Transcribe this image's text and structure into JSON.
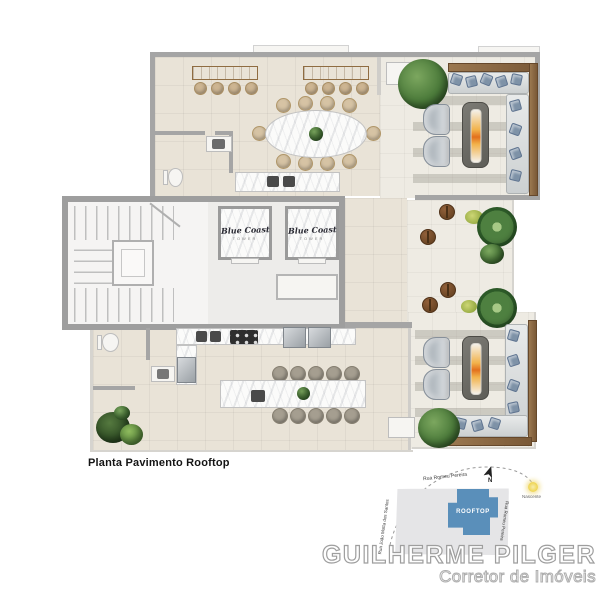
{
  "plan": {
    "caption": "Planta Pavimento Rooftop",
    "elevator_logo": "Blue Coast",
    "elevator_logo_sub": "TOWER"
  },
  "sitemap": {
    "building_label": "ROOFTOP",
    "north_label": "N",
    "sun_label": "Nascente",
    "street_top": "Rua Romeu Pereira",
    "street_right": "Rua Romeu Pereira",
    "street_left": "Rua João Motta dos Santos"
  },
  "branding": {
    "name": "GUILHERME PILGER",
    "subtitle": "Corretor de Imóveis"
  },
  "colors": {
    "building_blue": "#5a8fba",
    "wall_gray": "#a5a5a5",
    "floor_beige": "#e9e3d7",
    "deck_light": "#eeebe3",
    "wood_tan": "#bf9c6b",
    "wood_dark_frame": "#85613f",
    "plant_green": "#47743a",
    "flame_orange": "#e8921e",
    "brand_stroke_gray": "#9e9e9e"
  }
}
